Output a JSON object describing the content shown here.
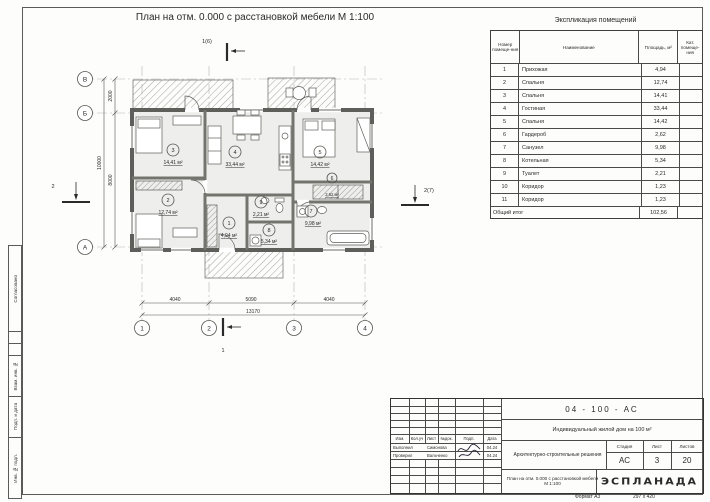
{
  "plan_title": "План на отм. 0.000 с расстановкой мебели М 1:100",
  "exp_table": {
    "title": "Экспликация помещений",
    "columns": {
      "num": "Номер помеще-ния",
      "name": "Наименование",
      "area": "Площадь, м²",
      "cat": "Кат. помеще-ния"
    },
    "rows": [
      {
        "num": "1",
        "name": "Прихожая",
        "area": "4,94"
      },
      {
        "num": "2",
        "name": "Спальня",
        "area": "12,74"
      },
      {
        "num": "3",
        "name": "Спальня",
        "area": "14,41"
      },
      {
        "num": "4",
        "name": "Гостиная",
        "area": "33,44"
      },
      {
        "num": "5",
        "name": "Спальня",
        "area": "14,42"
      },
      {
        "num": "6",
        "name": "Гардероб",
        "area": "2,62"
      },
      {
        "num": "7",
        "name": "Санузел",
        "area": "9,98"
      },
      {
        "num": "8",
        "name": "Котельная",
        "area": "5,34"
      },
      {
        "num": "9",
        "name": "Туалет",
        "area": "2,21"
      },
      {
        "num": "10",
        "name": "Коридор",
        "area": "1,23"
      },
      {
        "num": "11",
        "name": "Коридор",
        "area": "1,23"
      }
    ],
    "total_label": "Общий итог",
    "total_area": "102,56"
  },
  "plan": {
    "axes_h": [
      "1",
      "2",
      "3",
      "4"
    ],
    "axes_v": [
      "В",
      "Б",
      "А"
    ],
    "dims": {
      "bottom": [
        "4040",
        "5090",
        "4040"
      ],
      "bottom_total": "13170",
      "left": [
        "2000",
        "8000"
      ],
      "left_total": "10000"
    },
    "sections": {
      "top": "1(6)",
      "bottom": "1",
      "left": "2",
      "right": "2(7)"
    },
    "rooms": [
      {
        "n": "1",
        "a": "4,94 м²"
      },
      {
        "n": "2",
        "a": "12,74 м²"
      },
      {
        "n": "3",
        "a": "14,41 м²"
      },
      {
        "n": "4",
        "a": "33,44 м²"
      },
      {
        "n": "5",
        "a": "14,42 м²"
      },
      {
        "n": "6",
        "a": "2,62 м²"
      },
      {
        "n": "7",
        "a": "9,98 м²"
      },
      {
        "n": "8",
        "a": "5,34 м²"
      },
      {
        "n": "9",
        "a": "2,21 м²"
      }
    ]
  },
  "side_strip": {
    "items": [
      "Согласовано",
      "Взам. инв. №",
      "Подп. и дата",
      "Инв. № подл."
    ]
  },
  "title_block": {
    "code": "04 - 100 - АС",
    "object": "Индивидуальный жилой дом на 100 м²",
    "doc": "Архитектурно-строительные решения",
    "sheet_name": "План на отм. 0.000 с расстановкой мебели М 1:100",
    "stage_label": "Стадия",
    "stage": "АС",
    "list_label": "Лист",
    "list": "3",
    "lists_label": "Листов",
    "lists": "20",
    "org": "ЭСПЛАНАДА",
    "cols": [
      "Изм.",
      "Кол.уч",
      "Лист",
      "№док.",
      "Подп.",
      "Дата"
    ],
    "rows": [
      {
        "role": "Выполнил",
        "name": "Симонова",
        "date": "04.24"
      },
      {
        "role": "Проверил",
        "name": "Вальченко",
        "date": "04.24"
      }
    ],
    "format_label": "Формат А3",
    "format_size": "297 х 420"
  }
}
